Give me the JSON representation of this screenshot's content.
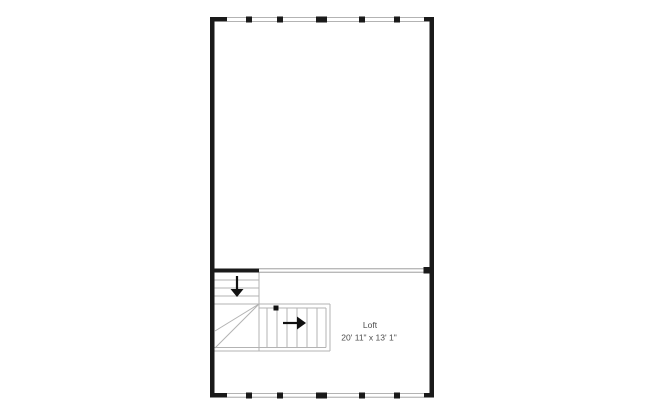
{
  "plan": {
    "room_label": "Loft",
    "room_dimensions": "20' 11\" x 13' 1\"",
    "icons": {
      "stair_down": "stair-down-arrow-icon",
      "stair_right": "stair-right-arrow-icon",
      "stair_start": "stair-start-marker"
    },
    "colors": {
      "background": "#ffffff",
      "wall": "#1a1a1a",
      "window_line": "#9a9a9a",
      "divider_line": "#8f8f8f",
      "stair_line": "#b3b3b3",
      "arrow": "#111111",
      "text": "#4d4d4d"
    }
  }
}
